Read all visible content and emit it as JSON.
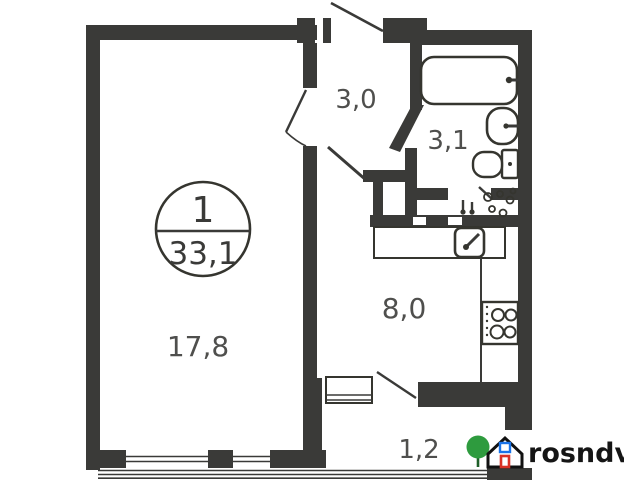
{
  "plan": {
    "stamp": {
      "rooms_count": "1",
      "total_area": "33,1"
    },
    "rooms": {
      "living": {
        "label": "17,8"
      },
      "hallway": {
        "label": "3,0"
      },
      "bathroom": {
        "label": "3,1"
      },
      "kitchen": {
        "label": "8,0"
      },
      "balcony": {
        "label": "1,2"
      }
    },
    "fixtures": [
      "bathtub",
      "wash-basin",
      "toilet",
      "plumbing-shaft",
      "kitchen-sink",
      "stove",
      "counter"
    ],
    "watermark": {
      "text": "rosndv.ru"
    },
    "colors": {
      "wall": "#3a3a38",
      "fixture_line": "#35352f",
      "room_label": "#4f4f4d",
      "logo_tree_green": "#2e9b3e",
      "logo_door_red": "#d93025",
      "logo_window_blue": "#1a73e8",
      "logo_text": "#151515"
    }
  }
}
